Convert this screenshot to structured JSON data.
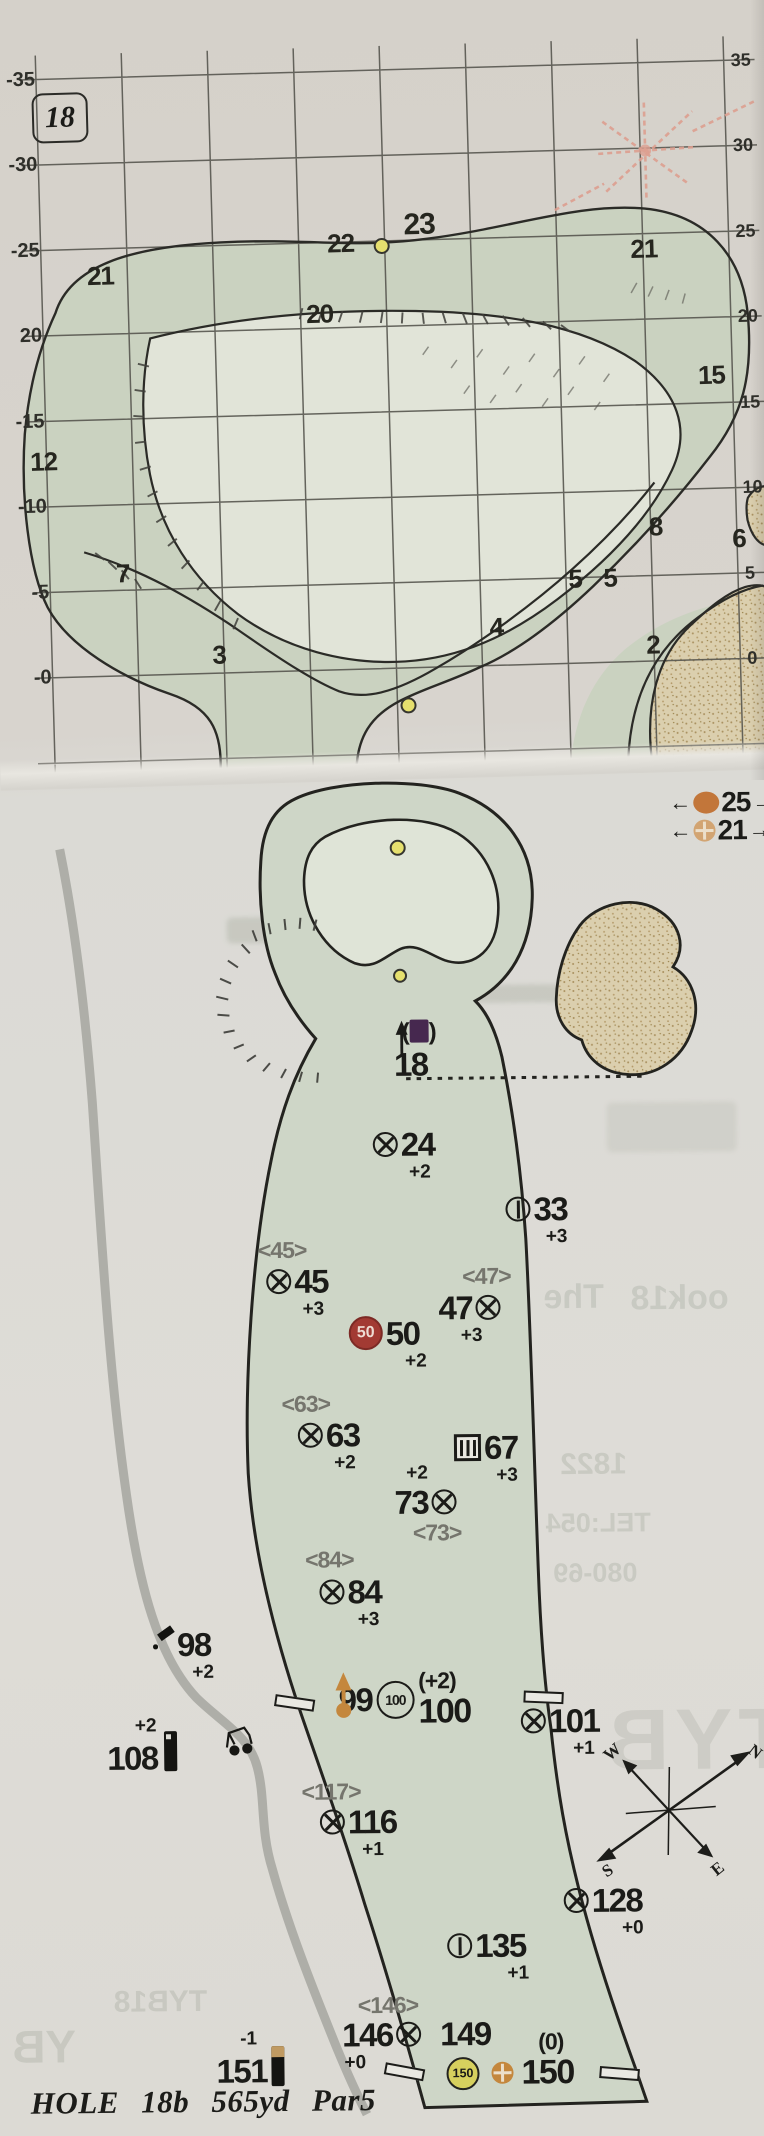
{
  "green_map": {
    "hole_badge": "18",
    "left_axis": [
      "-35",
      "-30",
      "-25",
      "20",
      "-15",
      "-10",
      "-5",
      "-0"
    ],
    "right_axis": [
      "35",
      "30",
      "25",
      "20",
      "15",
      "10",
      "5",
      "0"
    ],
    "contours": [
      "21",
      "22",
      "23",
      "21",
      "20",
      "15",
      "12",
      "8",
      "7",
      "6",
      "5",
      "5",
      "4",
      "3",
      "2"
    ]
  },
  "course_map": {
    "legend": {
      "left_arrow": "←",
      "right_arrow": "→",
      "items": [
        {
          "value": "25"
        },
        {
          "value": "21"
        }
      ]
    },
    "green_target": {
      "paren_open": "(",
      "paren_close": ")",
      "label": "18"
    },
    "markers": [
      {
        "value": "24",
        "delta": "+2"
      },
      {
        "value": "33",
        "delta": "+3"
      },
      {
        "paren": "<45>",
        "value": "45",
        "delta": "+3"
      },
      {
        "paren": "<47>",
        "value": "47",
        "delta": "+3"
      },
      {
        "badge": "50",
        "value": "50",
        "delta": "+2"
      },
      {
        "paren": "<63>",
        "value": "63",
        "delta": "+2"
      },
      {
        "value": "67",
        "delta": "+3"
      },
      {
        "delta": "+2",
        "value": "73",
        "paren": "<73>"
      },
      {
        "paren": "<84>",
        "value": "84",
        "delta": "+3"
      },
      {
        "value": "98",
        "delta": "+2"
      },
      {
        "value": "99",
        "badge": "100",
        "paren": "(+2)",
        "value2": "100"
      },
      {
        "value": "101",
        "delta": "+1"
      },
      {
        "value": "108",
        "delta": "+2"
      },
      {
        "paren": "<117>",
        "value": "116",
        "delta": "+1"
      },
      {
        "value": "128",
        "delta": "+0"
      },
      {
        "value": "135",
        "delta": "+1"
      },
      {
        "paren": "<146>",
        "value": "146",
        "delta": "+0"
      },
      {
        "value": "151",
        "delta": "-1"
      },
      {
        "value": "149"
      },
      {
        "badge": "150",
        "paren": "(0)",
        "value": "150"
      }
    ],
    "compass": {
      "n": "N",
      "e": "E",
      "s": "S",
      "w": "W"
    },
    "ghost_text": [
      "1822",
      "TEL:054",
      "080-69",
      "The",
      "ook18",
      "TYB",
      "http://tyb8.com",
      "tyb8.com",
      "TYB18",
      "YB"
    ]
  },
  "footer": "HOLE 18b 565yd Par5",
  "colors": {
    "green_band": "#cad2c0",
    "green_inner": "#e1e4d8",
    "fairway": "#ced6c7",
    "sand": "#dbcfae",
    "marker_red": "#a23a33",
    "accent_orange": "#c4873d",
    "yellow_disc": "#d6d05e",
    "yellow_dot": "#e6e06e",
    "purple": "#46284f",
    "cart_path_gray": "#a6a6a0"
  }
}
